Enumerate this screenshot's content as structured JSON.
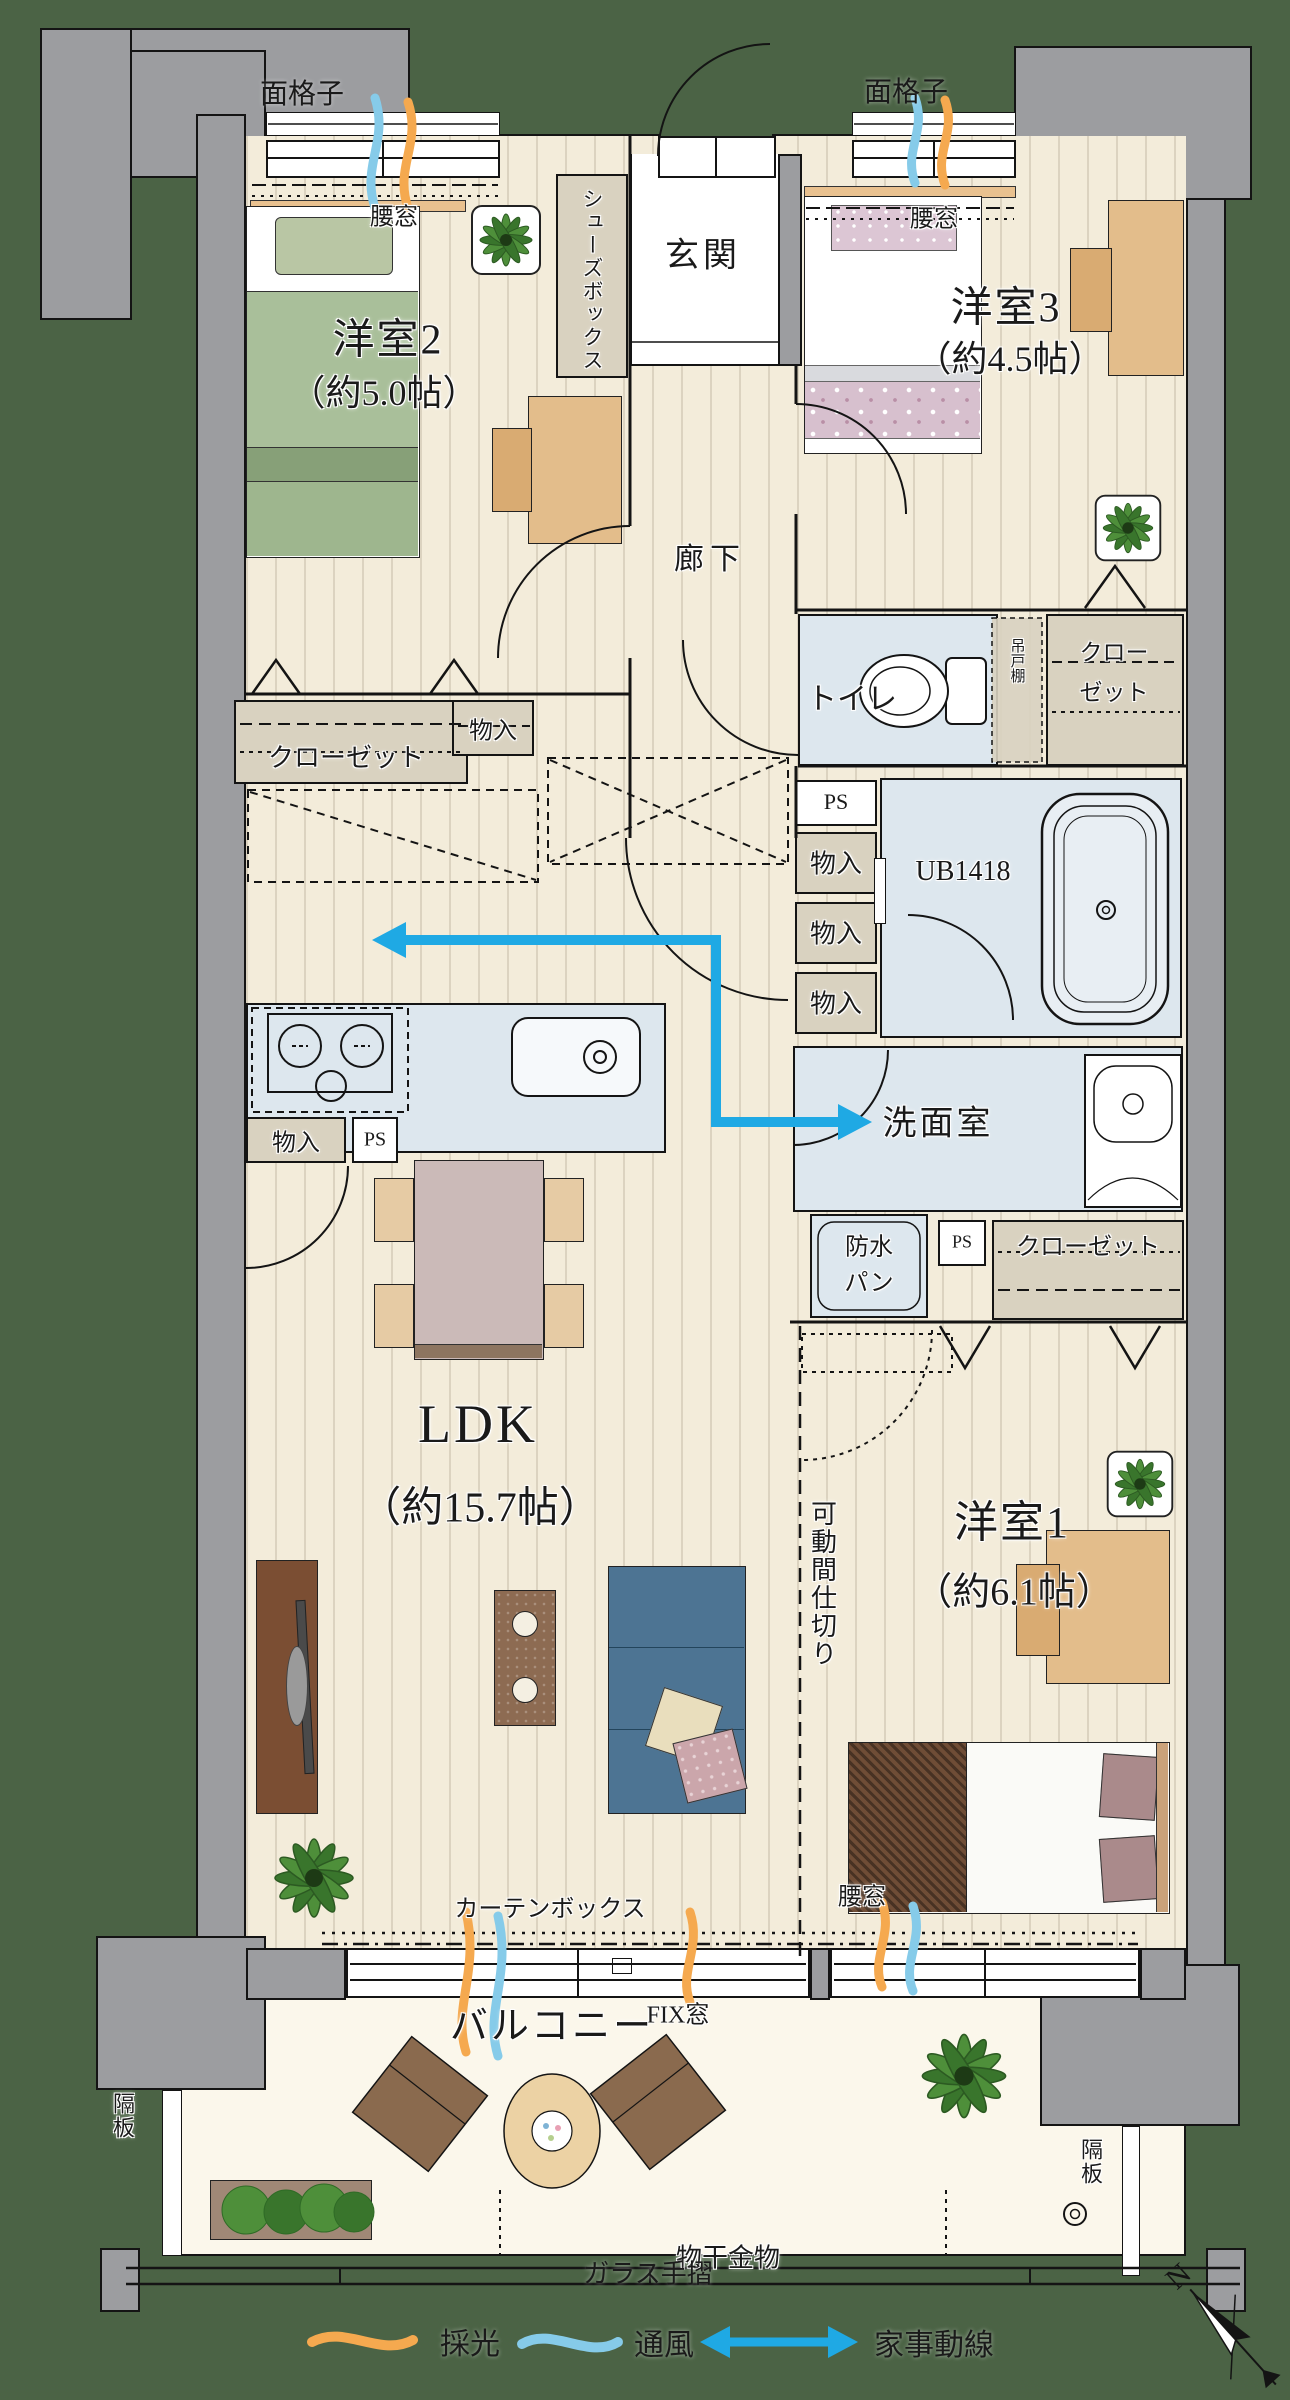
{
  "plan": {
    "rooms": {
      "genkan": "玄関",
      "rouka": "廊下",
      "youshitsu2": {
        "name": "洋室2",
        "size": "（約5.0帖）"
      },
      "youshitsu3": {
        "name": "洋室3",
        "size": "（約4.5帖）"
      },
      "youshitsu1": {
        "name": "洋室1",
        "size": "（約6.1帖）"
      },
      "ldk": {
        "name": "LDK",
        "size": "（約15.7帖）"
      },
      "toilet": "トイレ",
      "senmenshitsu": "洗面室",
      "unit_bath": "UB1418",
      "balcony": "バルコニー"
    },
    "storage": {
      "shoes_box": "シューズボックス",
      "closet": "クローゼット",
      "closet_line1": "クロー",
      "closet_line2": "ゼット",
      "monoiri": "物入",
      "tsuridotana": "吊戸棚",
      "ps": "PS"
    },
    "features": {
      "mengoushi": "面格子",
      "koshimado": "腰窓",
      "fix_mado": "FIX窓",
      "curtain_box": "カーテンボックス",
      "kadou_majikiri": "可動間仕切り",
      "bousuipan_line1": "防水",
      "bousuipan_line2": "パン",
      "monohoshi_kanamono": "物干金物",
      "kakuita": "隔板",
      "glass_tesuri": "ガラス手摺"
    },
    "legend": {
      "daylight": "採光",
      "ventilation": "通風",
      "housework_line": "家事動線"
    },
    "compass_north": "N",
    "colors": {
      "background": "#4b6345",
      "wall_gray": "#9c9da0",
      "floor": "#f3ecda",
      "wet_room_blue": "#dde7ee",
      "storage_beige": "#d9d2c0",
      "daylight_orange": "#f5a94f",
      "ventilation_blue": "#86cbe9",
      "housework_arrow_blue": "#1fa9e4"
    }
  }
}
